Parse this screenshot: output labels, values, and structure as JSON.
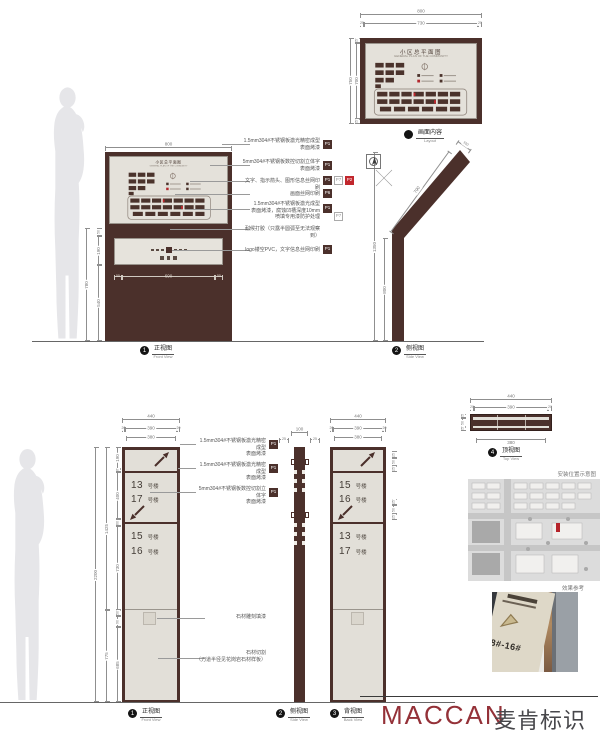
{
  "colors": {
    "sign_brown": "#4b302b",
    "panel_face": "#e4e1da",
    "accent_red": "#c1272d",
    "logo_red": "#943138",
    "logo_gray": "#47474b",
    "silhouette": "#e6e6e9"
  },
  "brand": {
    "name": "MACCAN",
    "name_zh": "麦肯标识"
  },
  "detail": {
    "title_zh": "小区总平面图",
    "title_en": "GENERAL PLAN OF THE COMMUNITY",
    "caption_zh": "画面内容",
    "caption_en": "Layout",
    "dims": {
      "total_w": "800",
      "m_l": "25",
      "inner_w": "730",
      "m_r": "25",
      "total_h": "750",
      "m_t": "25",
      "inner_h": "700",
      "m_b": "25"
    }
  },
  "view1": {
    "no": "1",
    "zh": "正视图",
    "en": "Front View",
    "dims": {
      "width": "800",
      "body_h": "780",
      "seg_top": "50",
      "seg_plaque": "190",
      "seg_base": "540",
      "base_l": "55",
      "base_c": "690",
      "base_r": "55"
    }
  },
  "view2": {
    "no": "2",
    "zh": "侧视图",
    "en": "Side View",
    "dims": {
      "height": "1350",
      "post": "800",
      "arm": "790",
      "tip": "100"
    }
  },
  "annotations1": [
    {
      "text": "1.5mm304#不锈钢板激光精密成型\n表面烤漆",
      "badges": [
        "P1"
      ]
    },
    {
      "text": "5mm304#不锈钢板数控切割立体字\n表面烤漆",
      "badges": [
        "P1"
      ]
    },
    {
      "text": "文字、指示箭头、图形信息丝网印刷",
      "badges": [
        "P1",
        "P7",
        "P2"
      ]
    },
    {
      "text": "画面丝网印刷",
      "badges": [
        "P6"
      ]
    },
    {
      "text": "1.5mm304#不锈钢板激光成型\n表面烤漆，腐蚀凹槽深度10mm\n喷填专用漆防护处理",
      "badges": [
        "P1",
        "P7"
      ]
    },
    {
      "text": "耐候打胶（只露半圆弧至无法观察到）",
      "badges": []
    },
    {
      "text": "logo镂空PVC，文字信息丝网印刷",
      "badges": [
        "P1"
      ]
    }
  ],
  "tower": {
    "front": {
      "no": "1",
      "zh": "正视图",
      "en": "Front View",
      "groups": [
        {
          "lines": [
            {
              "num": "13",
              "suffix": "号楼"
            },
            {
              "num": "17",
              "suffix": "号楼"
            }
          ]
        },
        {
          "lines": [
            {
              "num": "15",
              "suffix": "号楼"
            },
            {
              "num": "16",
              "suffix": "号楼"
            }
          ]
        }
      ]
    },
    "back": {
      "no": "3",
      "zh": "背视图",
      "en": "Back View",
      "groups": [
        {
          "lines": [
            {
              "num": "15",
              "suffix": "号楼"
            },
            {
              "num": "16",
              "suffix": "号楼"
            }
          ]
        },
        {
          "lines": [
            {
              "num": "13",
              "suffix": "号楼"
            },
            {
              "num": "17",
              "suffix": "号楼"
            }
          ]
        }
      ]
    },
    "side": {
      "no": "2",
      "zh": "侧视图",
      "en": "Side View",
      "dims": {
        "w": "100",
        "m_l": "25",
        "m_r": "25"
      }
    },
    "top": {
      "no": "4",
      "zh": "顶视图",
      "en": "Top View",
      "dims": {
        "w": "440",
        "m_l": "20",
        "inner": "390",
        "m_r": "20",
        "face": "380",
        "d1": "25",
        "d2": "50",
        "d3": "25"
      }
    },
    "dims": {
      "w": "440",
      "m_l": "20",
      "inner": "390",
      "m_r": "20",
      "face": "380",
      "h_total": "2200",
      "h_upper": "1425",
      "h_lower": "775",
      "segs": [
        "190",
        "30",
        "400",
        "60",
        "730",
        "50",
        "90",
        "685"
      ],
      "back_segs": [
        "25",
        "50",
        "25",
        "25",
        "50",
        "25"
      ]
    }
  },
  "annotations2": [
    {
      "text": "1.5mm304#不锈钢板激光精密成型\n表面烤漆",
      "badges": [
        "P1"
      ]
    },
    {
      "text": "1.5mm304#不锈钢板激光精密成型\n表面烤漆",
      "badges": [
        "P1"
      ]
    },
    {
      "text": "5mm304#不锈钢板数控切割立体字\n表面烤漆",
      "badges": [
        "P1"
      ]
    },
    {
      "text": "石材雕刻填漆",
      "badges": []
    },
    {
      "text": "石材切割\n（刀道半径见花岗岩石材样板）",
      "badges": []
    }
  ],
  "references": {
    "site_plan_label": "安装位置示意图",
    "photo_label": "效果参考",
    "photo_sign_text": "8#-16#"
  }
}
